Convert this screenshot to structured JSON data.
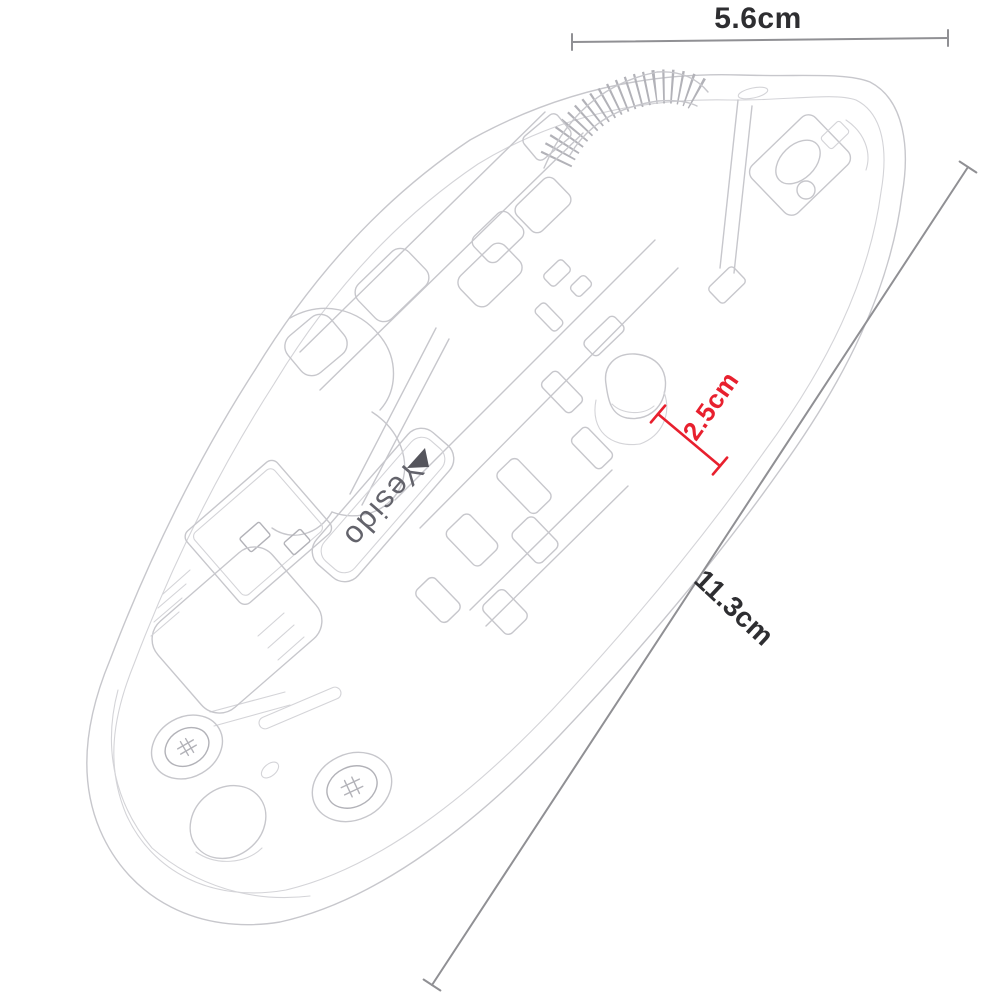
{
  "page": {
    "background": "#ffffff",
    "description_text": ""
  },
  "colors": {
    "accent_red": "#e8202e",
    "dimension_line": "#909094",
    "sketch_line": "#c7c7cc",
    "sketch_line_soft": "#d4d4d8",
    "sketch_line_dark": "#b2b2b8",
    "text_dark": "#2e2e31",
    "brand_text": "#63636b",
    "brand_triangle": "#55555c"
  },
  "product": {
    "brand_label": "Yesido"
  },
  "annotations": {
    "top_width": {
      "label": "5.6cm",
      "value_cm": 5.6,
      "orientation": "horizontal"
    },
    "side_length": {
      "label": "11.3cm",
      "value_cm": 11.3,
      "orientation": "diagonal"
    },
    "thickness": {
      "label": "2.5cm",
      "value_cm": 2.5,
      "orientation": "diagonal",
      "color": "#e8202e"
    }
  },
  "figure": {
    "kind": "wireframe product sketch of wireless mouse (bottom/internal view)",
    "parts": [
      "mouse-outline",
      "scroll-wheel",
      "top-shell-seams",
      "button-components",
      "battery-cover-slots",
      "sensor-button",
      "logo-plate",
      "usb-receiver",
      "screws",
      "rubber-foot"
    ]
  }
}
